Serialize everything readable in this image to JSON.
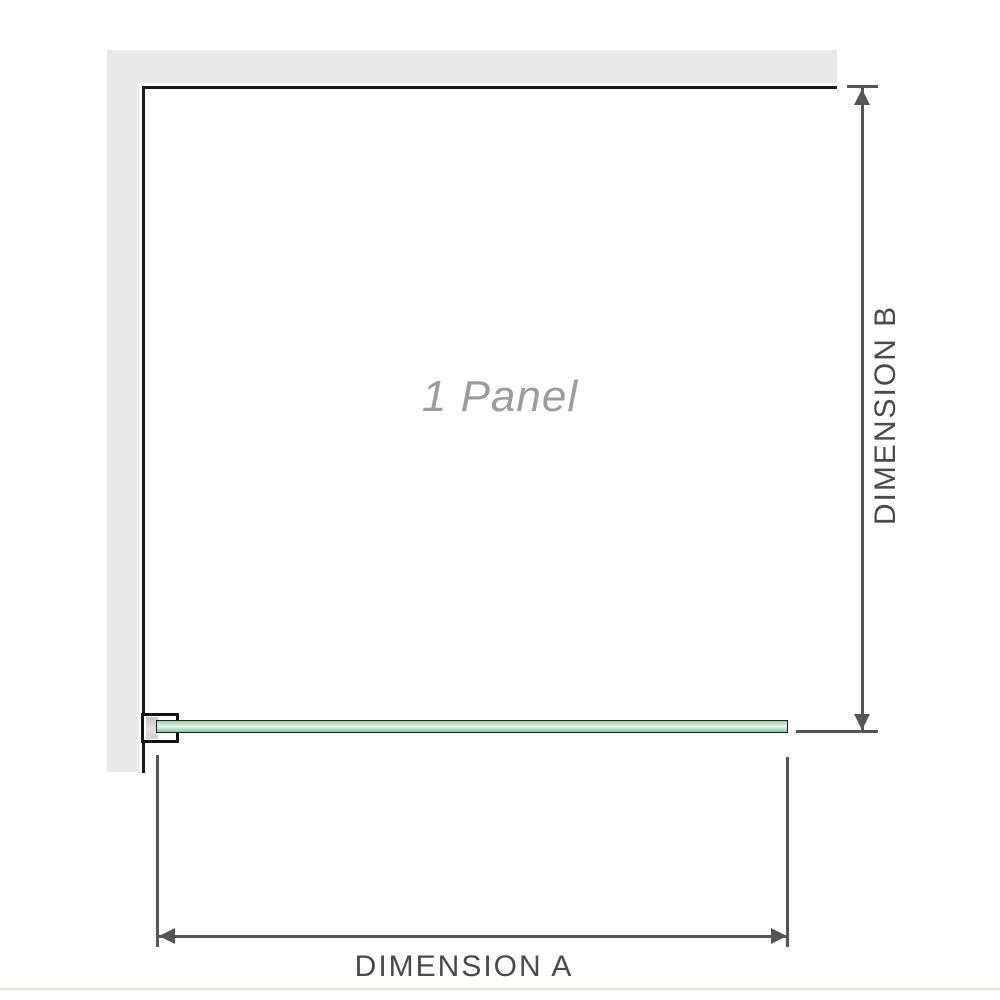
{
  "diagram": {
    "panel_label": "1 Panel",
    "dimensions": {
      "a": {
        "label": "DIMENSION A",
        "orientation": "horizontal"
      },
      "b": {
        "label": "DIMENSION B",
        "orientation": "vertical"
      }
    },
    "colors": {
      "wall_gray": "#e9e9e9",
      "enclosure_outline": "#1a1a1a",
      "dimension_lines": "#555555",
      "dimension_text": "#4a4a4a",
      "watermark_text": "#9c9c9c",
      "glass_green": "#9cd6b0",
      "glass_highlight": "#e9f5ec",
      "baseline": "#e6e5e1"
    }
  }
}
